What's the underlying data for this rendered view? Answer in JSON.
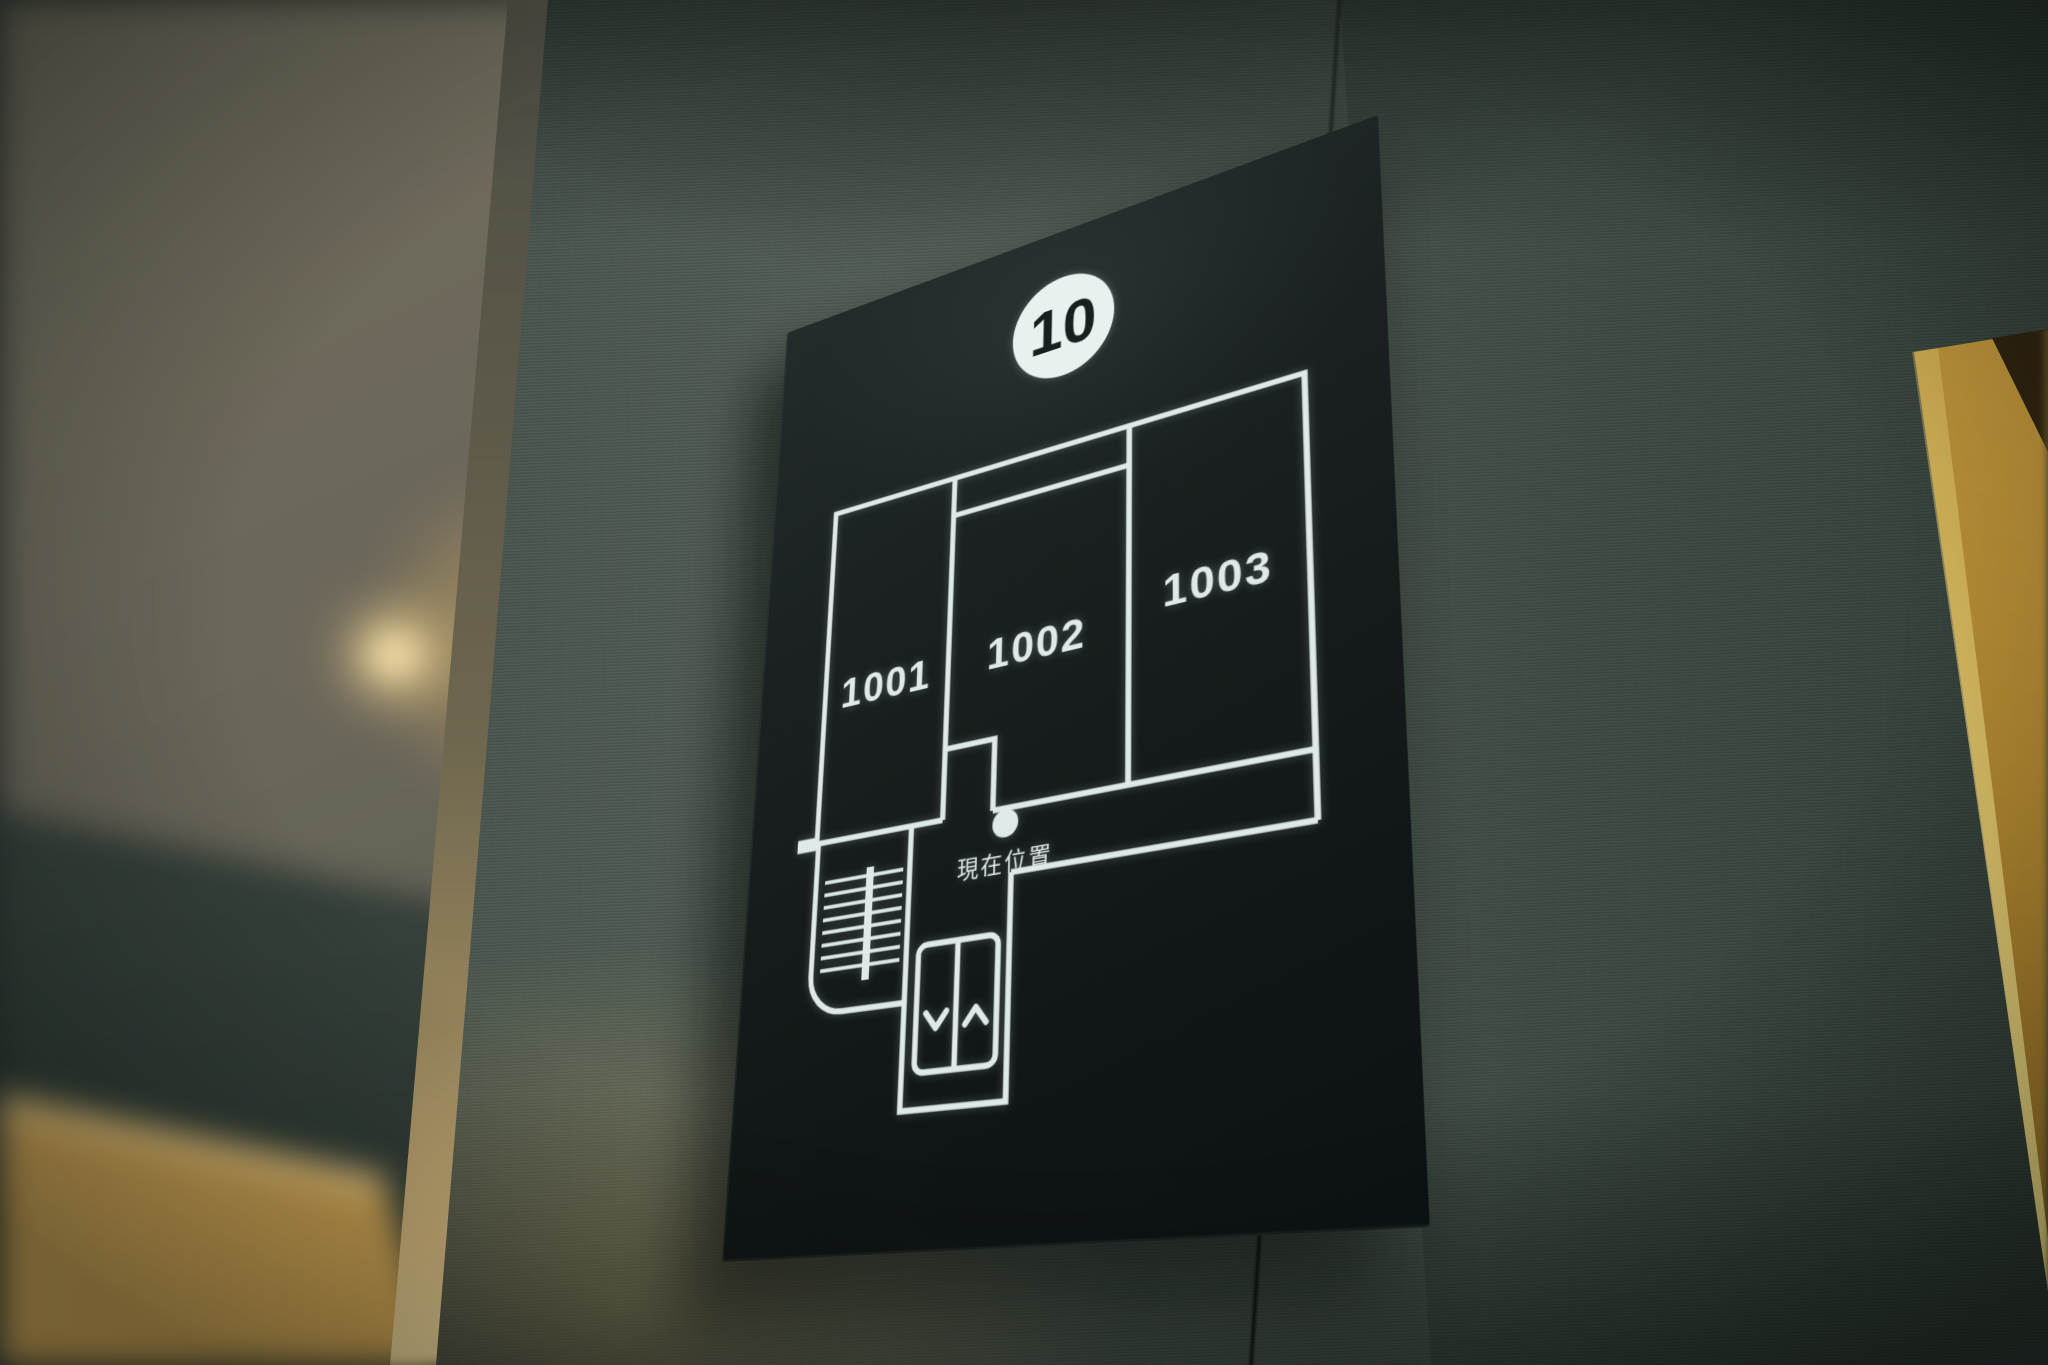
{
  "sign": {
    "floor_number": "10",
    "rooms": [
      {
        "number": "1001"
      },
      {
        "number": "1002"
      },
      {
        "number": "1003"
      }
    ],
    "current_location_label": "現在位置",
    "colors": {
      "panel": "#151b1a",
      "line": "#dfeae8",
      "badge_fill": "#e9f1ef",
      "badge_text": "#18201f"
    },
    "icons": {
      "stairs": "stairs-icon",
      "elevator": "elevator-icon",
      "elevator_down": "chevron-down-icon",
      "elevator_up": "chevron-up-icon",
      "current_location": "location-dot-icon"
    }
  },
  "environment": {
    "colors": {
      "wallpaper": "#4b564f",
      "corner_light": "#e8c87e",
      "wood_door": "#c99c49",
      "door_frame": "#b08630"
    }
  }
}
